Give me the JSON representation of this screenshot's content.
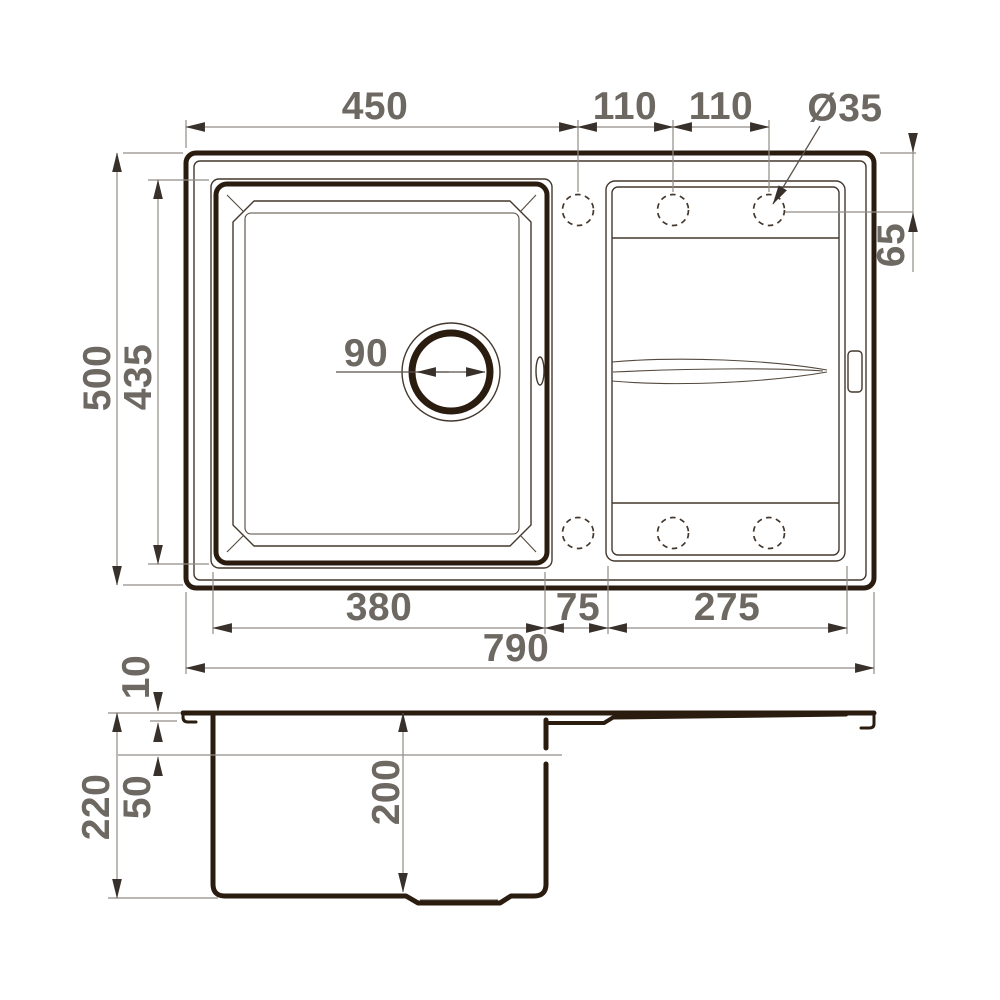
{
  "top_view": {
    "labels": {
      "top_width": "450",
      "hole_pitch_left": "110",
      "hole_pitch_right": "110",
      "hole_diameter": "Ø35",
      "hole_offset_right": "65",
      "overall_depth": "500",
      "bowl_outer_depth": "435",
      "drain_diameter": "90",
      "bowl_width": "380",
      "middle_gap": "75",
      "drainboard_width": "275",
      "overall_width": "790"
    }
  },
  "section_view": {
    "labels": {
      "rim_height": "10",
      "water_level_depth": "50",
      "overall_height": "220",
      "bowl_depth": "200"
    }
  },
  "colors": {
    "line_heavy": "#2b1c10",
    "line_thin": "#44382d",
    "dim_line": "#918c86",
    "dim_text": "#6d6862",
    "background": "#ffffff"
  }
}
